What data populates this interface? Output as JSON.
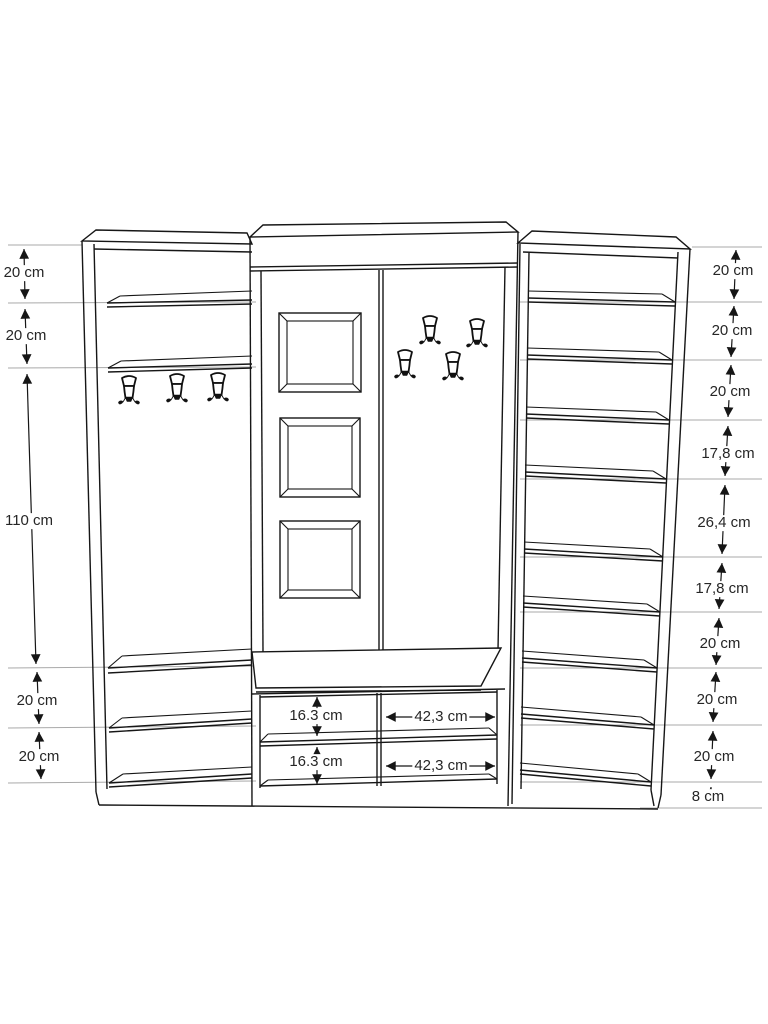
{
  "diagram": {
    "kind": "furniture technical drawing",
    "subject": "hallway wardrobe with mirror panel, coat hooks, bench and shoe shelves",
    "unit": "cm",
    "colors": {
      "line": "#161616",
      "extension_line": "#a9a9a9",
      "text": "#262626",
      "background": "#ffffff"
    },
    "left_dimensions": [
      "20 cm",
      "20 cm",
      "110 cm",
      "20 cm",
      "20 cm"
    ],
    "right_dimensions": [
      "20 cm",
      "20 cm",
      "20 cm",
      "17,8 cm",
      "26,4 cm",
      "17,8 cm",
      "20 cm",
      "20 cm",
      "20 cm",
      "8 cm"
    ],
    "bench_dimensions": {
      "row1_depth": "16.3 cm",
      "row1_width": "42,3 cm",
      "row2_depth": "16.3 cm",
      "row2_width": "42,3 cm"
    },
    "features": {
      "left_section_hooks": 3,
      "middle_section_hooks": 4,
      "mirror_frames": 3
    }
  }
}
